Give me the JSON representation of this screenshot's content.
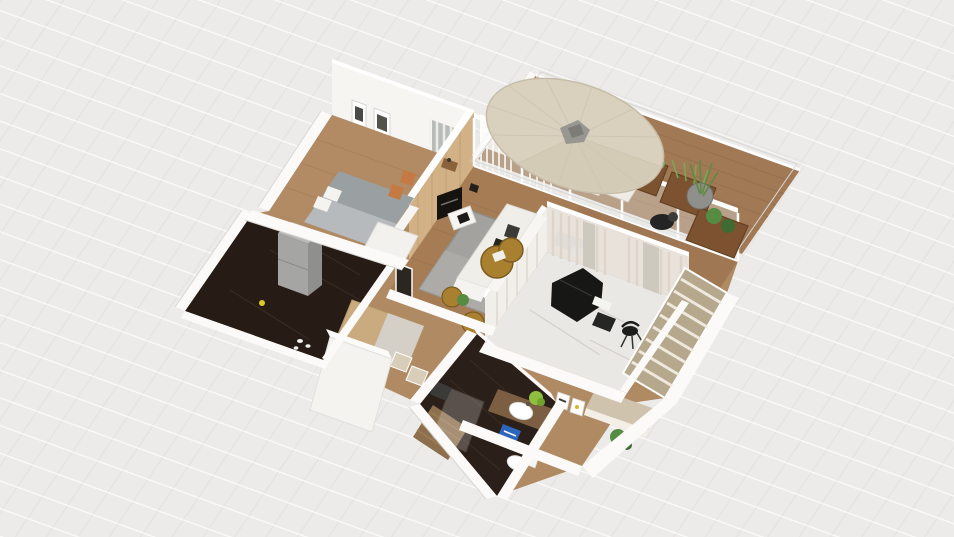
{
  "scene": {
    "type": "floor-plan-3d-render-viewport",
    "background": "#ecebe9",
    "grid_line": "#ffffff"
  },
  "legend": {
    "rooms": [
      {
        "id": "bedroom"
      },
      {
        "id": "living-room"
      },
      {
        "id": "kitchen"
      },
      {
        "id": "entry-hall"
      },
      {
        "id": "bathroom"
      },
      {
        "id": "piano-room"
      },
      {
        "id": "wardrobe-hallway"
      },
      {
        "id": "balcony"
      }
    ],
    "furniture": [
      "bed",
      "wall-frames",
      "curtains",
      "tv",
      "tv-accent-wall",
      "sofa",
      "rattan-poufs",
      "fridge",
      "dining-table",
      "chairs",
      "shower",
      "sink",
      "toilet",
      "grand-piano",
      "piano-bench",
      "desk-chair",
      "louver-closet",
      "console-bench",
      "parasol",
      "lounge-chair",
      "wood-planters",
      "potted-plants",
      "round-planter"
    ]
  },
  "palette": {
    "wall": "#fbfaf8",
    "wall_face": "#f6f5f2",
    "wall_shade": "#dedcd8",
    "base_wood": "#b08a62",
    "bedroom_wood": "#b28a63",
    "living_wood": "#a67c54",
    "corridor_wood": "#9f7853",
    "deck_wood": "#96683f",
    "kitchen_floor": "#261c15",
    "bath_floor": "#2b2019",
    "marble_floor": "#eae8e4",
    "rug": "#a3a29e",
    "bed": "#9aa0a2",
    "bed_blanket": "#b9bdbf",
    "accent_wall": "#d2b186",
    "sofa": "#efeee9",
    "tv": "#15120f",
    "pouf": "#a9802f",
    "piano": "#171715",
    "louver": "#b5a88c",
    "bench": "#cfc3ae",
    "umbrella": "#d9d1bd",
    "umbrella_shade": "#cdc4ae",
    "planter": "#7c5230",
    "plant_dark": "#3f6b33",
    "plant_mid": "#558b42",
    "plant_light": "#79a85c",
    "glass": "#e4e8e7",
    "curtain": "#efece7",
    "curtain_stripe": "#dcd5ca",
    "window_pane": "#b8bcb8",
    "fridge_front": "#a5a5a3",
    "fridge_side": "#8f8f8d",
    "fridge_top": "#b7b7b5",
    "sink_counter": "#7c5f42",
    "blue_kit": "#2f66bd",
    "chair_orange": "#c47a42",
    "gray_mat": "#3f3b36",
    "lime_plant": "#8fbf3f"
  }
}
